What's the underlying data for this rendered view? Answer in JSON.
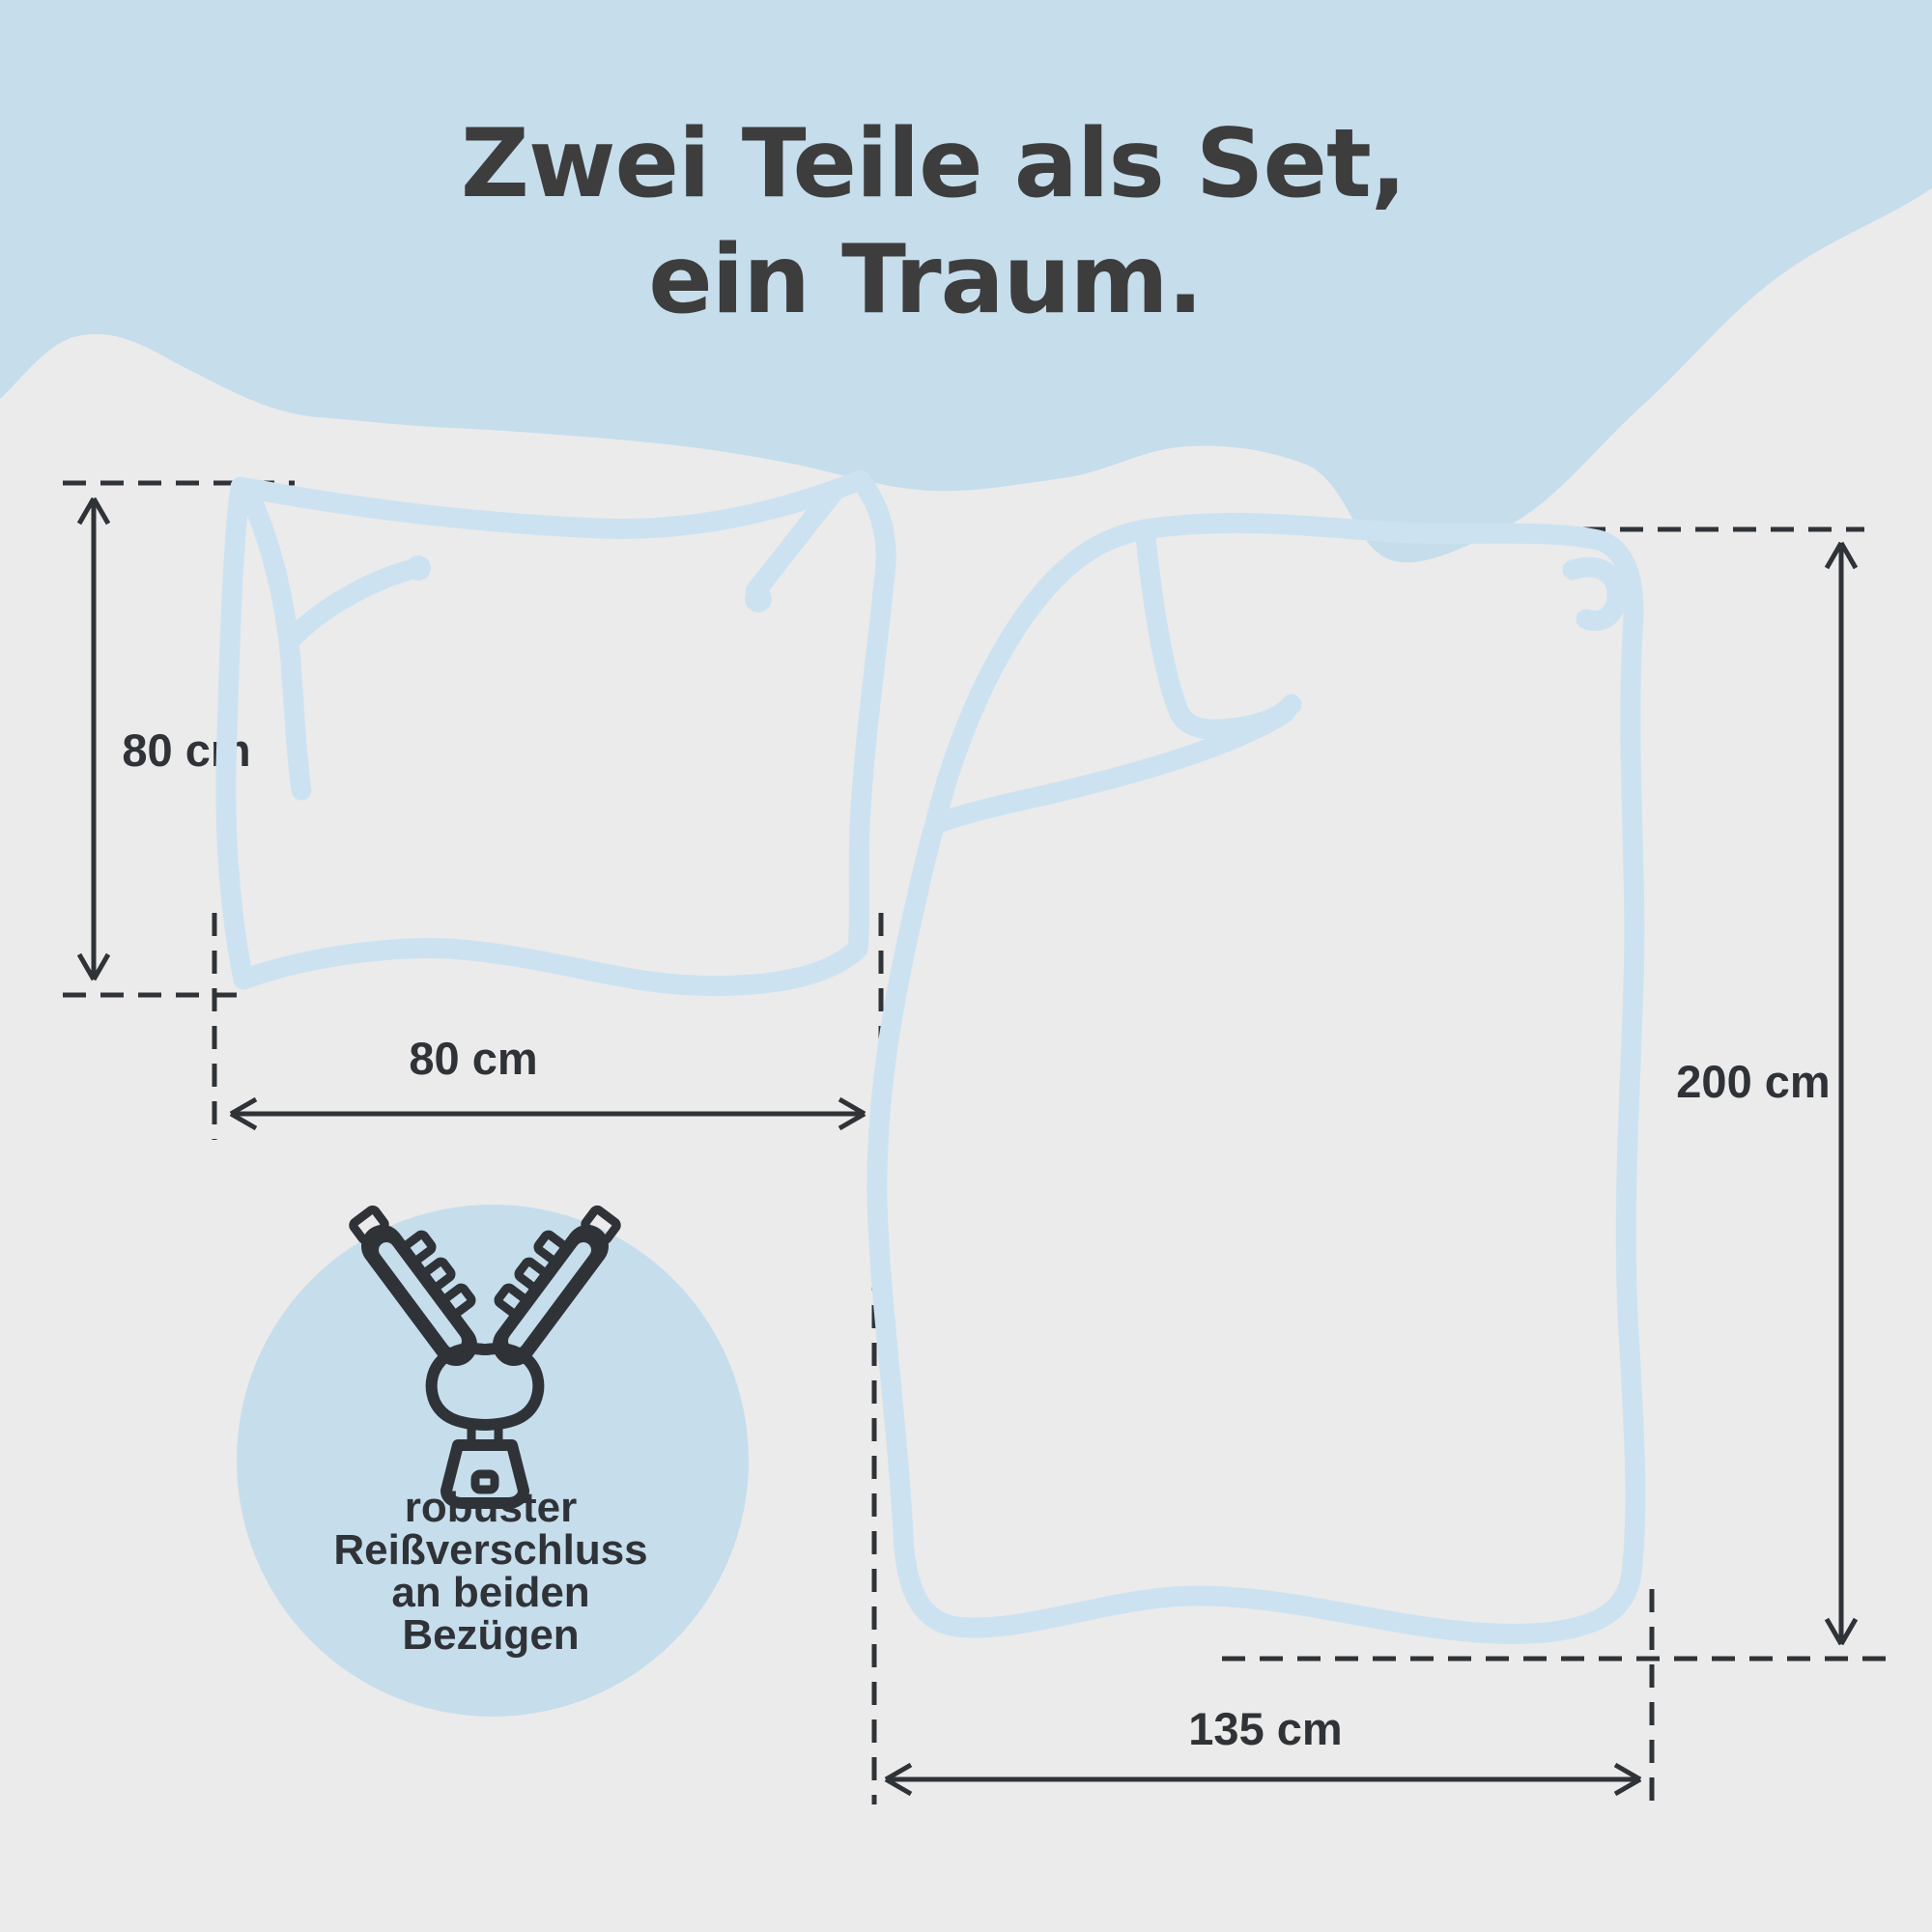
{
  "title": {
    "line1": "Zwei Teile als Set,",
    "line2": "ein Traum."
  },
  "diagram": {
    "pillow": {
      "name": "pillow outline sketch",
      "height_label": "80 cm",
      "width_label": "80 cm"
    },
    "duvet": {
      "name": "duvet cover outline sketch",
      "height_label": "200 cm",
      "width_label": "135 cm"
    }
  },
  "feature_badge": {
    "icon": "zipper-icon",
    "lines": [
      "robuster",
      "Reißverschluss",
      "an beiden",
      "Bezügen"
    ],
    "full_text": "robuster Reißverschluss an beiden Bezügen"
  },
  "colors": {
    "accent_blue": "#c6ddec",
    "outline_blue": "#cde2f1",
    "bg_gray": "#ebebeb",
    "ink_dark": "#2f3337",
    "title_gray": "#3d3d3d"
  }
}
